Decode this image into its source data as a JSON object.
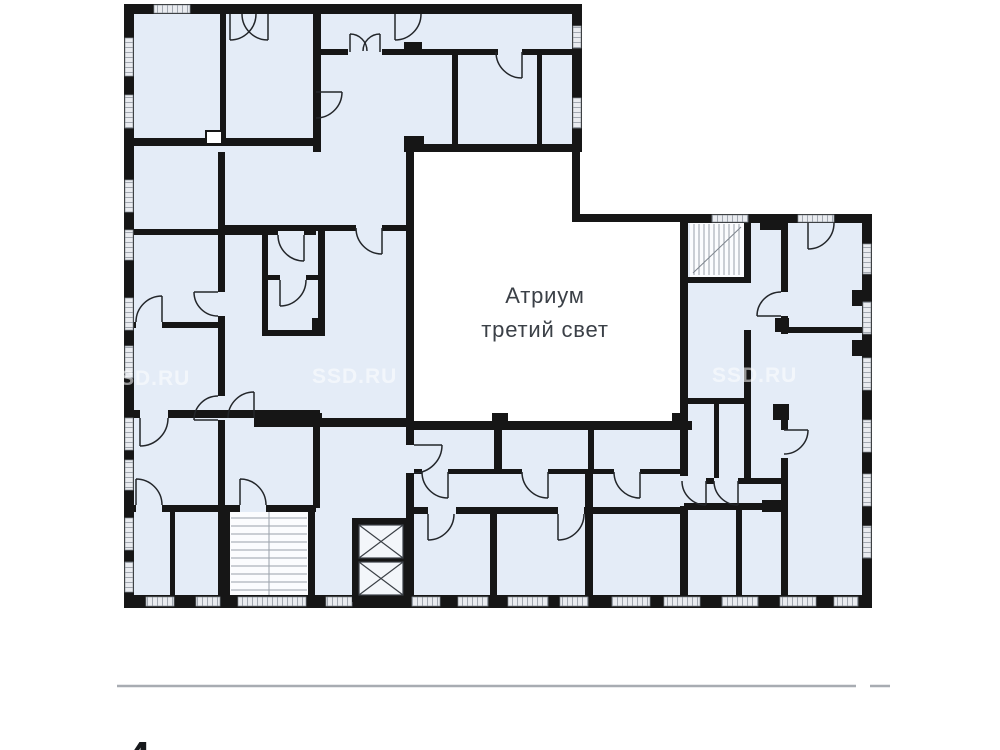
{
  "plan": {
    "atrium": {
      "line1": "Атриум",
      "line2": "третий свет"
    },
    "watermark": "SSD.RU",
    "floor": {
      "number": "4",
      "word": "этаж"
    }
  },
  "colors": {
    "wall": "#161616",
    "room_fill": "#e4ecf7",
    "atrium_fill": "#ffffff",
    "window_hatch": "#a2a8b1",
    "divider": "#a8acb2",
    "label_text": "#3b4047",
    "watermark_text": "#ffffff",
    "floor_number_text": "#17191c",
    "floor_word_text": "#c5c9ce"
  }
}
